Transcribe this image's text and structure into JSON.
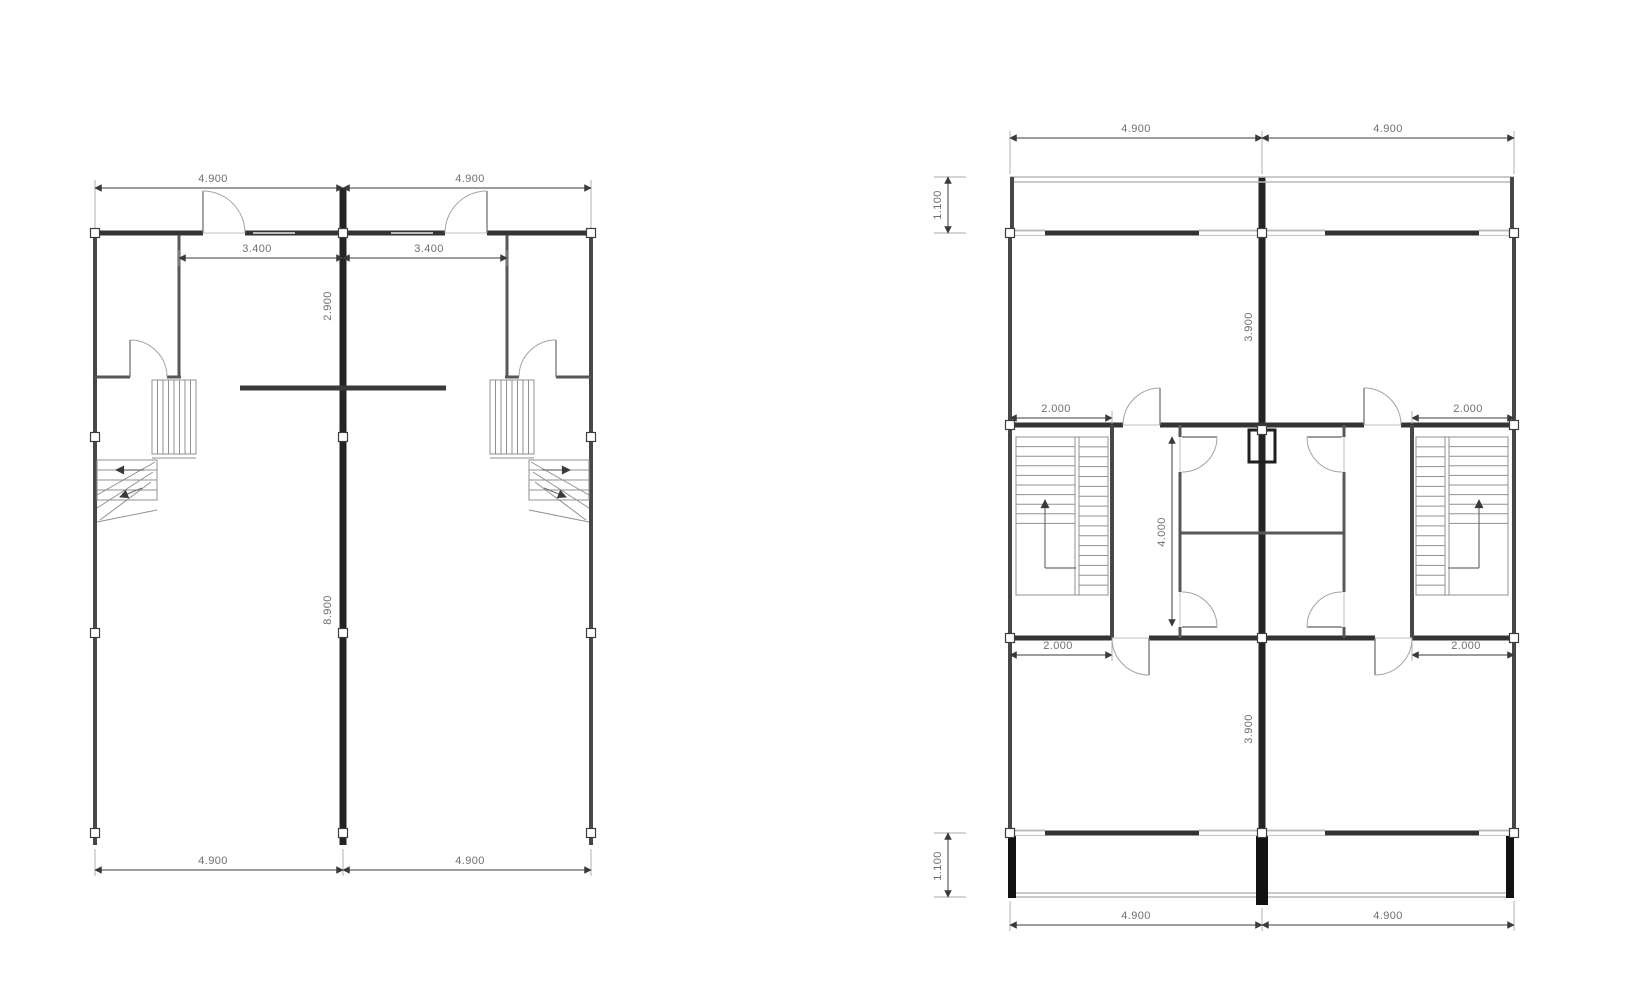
{
  "page": {
    "background_color": "#ffffff"
  },
  "ground_floor_plan": {
    "dimensions": {
      "top": [
        "4.900",
        "4.900"
      ],
      "front_rooms": [
        "3.400",
        "3.400"
      ],
      "front_depth": "2.900",
      "hall_depth": "8.900",
      "bottom": [
        "4.900",
        "4.900"
      ]
    }
  },
  "upper_floor_plan": {
    "dimensions": {
      "top": [
        "4.900",
        "4.900"
      ],
      "front_balcony_depth": "1.100",
      "front_room_depth": "3.900",
      "front_stair_width": [
        "2.000",
        "2.000"
      ],
      "core_depth": "4.000",
      "rear_stair_width": [
        "2.000",
        "2.000"
      ],
      "rear_room_depth": "3.900",
      "rear_balcony_depth": "1.100",
      "bottom": [
        "4.900",
        "4.900"
      ]
    }
  },
  "colors": {
    "wall": "#333333",
    "party_wall": "#242424",
    "solid_black_wall": "#121212",
    "window": "#bdbdbd",
    "dimension_line": "#3a3a3a",
    "dimension_text": "#6f6f6f",
    "stair_line": "#909090"
  }
}
